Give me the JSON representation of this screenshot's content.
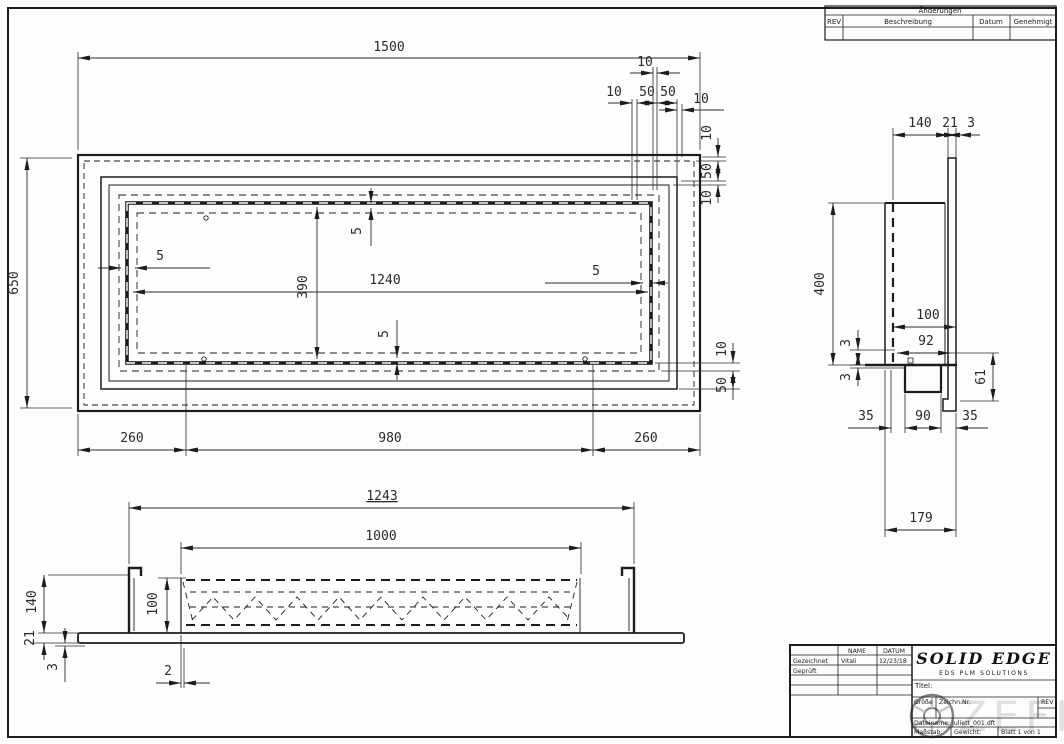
{
  "changes": {
    "title": "Änderungen",
    "col_rev": "REV",
    "col_desc": "Beschreibung",
    "col_date": "Datum",
    "col_appr": "Genehmigt"
  },
  "plan": {
    "width": "1500",
    "height": "650",
    "top_a": "10",
    "top_b": "10",
    "top_c": "50",
    "top_d": "50",
    "top_e": "10",
    "right_a": "10",
    "right_b": "50",
    "right_c": "10",
    "rb_a": "10",
    "rb_b": "50",
    "wall_left": "5",
    "wall_top": "5",
    "wall_bot": "5",
    "wall_right": "5",
    "inner_w": "1240",
    "inner_h": "390",
    "bot_a": "260",
    "bot_b": "980",
    "bot_c": "260"
  },
  "side": {
    "a": "140",
    "b": "21",
    "c": "3",
    "h": "400",
    "d": "100",
    "e": "92",
    "f": "3",
    "g": "3",
    "i": "61",
    "j": "35",
    "k": "90",
    "l": "35",
    "m": "179"
  },
  "front": {
    "a": "1243",
    "b": "1000",
    "c": "140",
    "d": "100",
    "e": "21",
    "f": "3",
    "g": "2"
  },
  "titleblock": {
    "name": "NAME",
    "datum": "DATUM",
    "drawn_label": "Gezeichnet",
    "drawn_name": "Vitali",
    "drawn_date": "12/23/18",
    "checked_label": "Geprüft",
    "brand": "SOLID EDGE",
    "brand_sub": "EDS PLM SOLUTIONS",
    "title_label": "Titel:",
    "size_label": "Größe",
    "docno_label": "Zeichn.Nr.",
    "rev_label": "REV",
    "file_label": "Dateiname: Juliett_001.dft",
    "scale_label": "Maßstab:",
    "weight_label": "Gewicht:",
    "sheet_label": "Blatt 1 von 1"
  },
  "watermark": {
    "text": "ZEFIRE"
  }
}
